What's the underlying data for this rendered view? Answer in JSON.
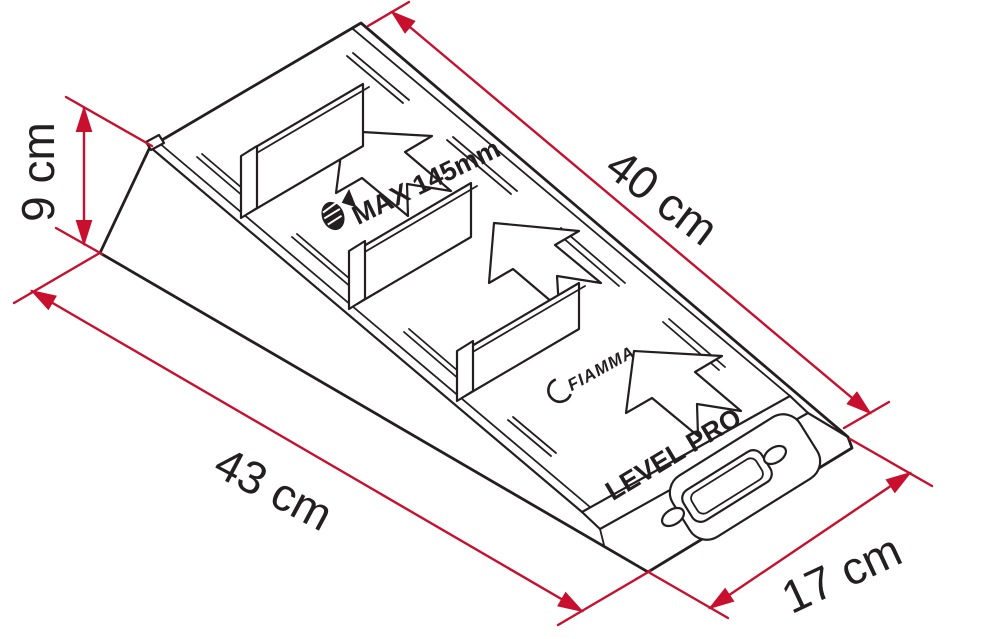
{
  "figure": {
    "kind": "technical-line-drawing",
    "subject": "wheel levelling ramp, isometric view",
    "background": "#ffffff",
    "line_color": "#231f20",
    "dimension_color": "#c8102e"
  },
  "dimensions": {
    "slope_length": "40 cm",
    "height": "9 cm",
    "overall_length": "43 cm",
    "width": "17 cm"
  },
  "markings": {
    "max_wheel_width": "MAX 145mm",
    "brand": "FIAMMA",
    "model": "LEVEL PRO"
  },
  "icons": [
    "wheel-stop-icon",
    "traction-arrow",
    "dimension-arrowhead"
  ]
}
